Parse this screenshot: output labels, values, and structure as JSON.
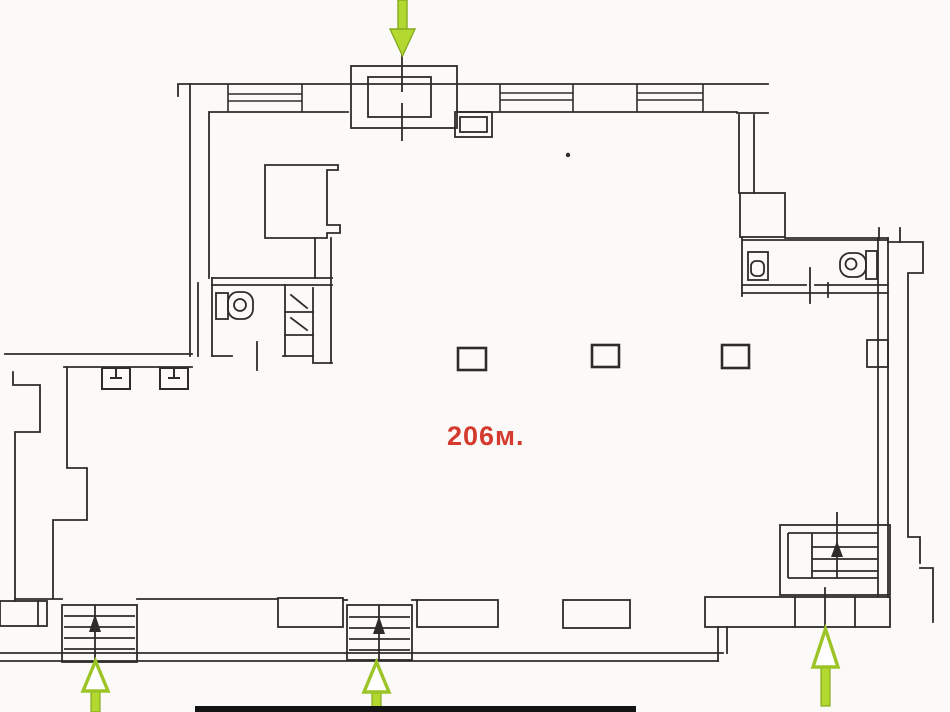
{
  "plan": {
    "area_label": "206м."
  },
  "colors": {
    "wall_line": "#2e2c29",
    "arrow_green": "#b3d930",
    "arrow_outline": "#85aa1e",
    "label_red": "#d43a2e",
    "paper": "#fbfaf8",
    "bottom_bar_black": "#141414"
  },
  "icons": {
    "entrance_arrows": [
      {
        "name": "entrance-arrow-top",
        "direction": "down"
      },
      {
        "name": "entrance-arrow-bottom-left",
        "direction": "up"
      },
      {
        "name": "entrance-arrow-bottom-center",
        "direction": "up"
      },
      {
        "name": "entrance-arrow-bottom-right",
        "direction": "up"
      }
    ],
    "fixtures": [
      "toilet-icon-left-wc",
      "sink-compartments-left-wc",
      "sink-icon-right-wc",
      "toilet-icon-right-wc",
      "stairs-icon-bottom-left",
      "stairs-icon-bottom-center",
      "stairs-icon-bottom-right",
      "column-markers"
    ]
  }
}
